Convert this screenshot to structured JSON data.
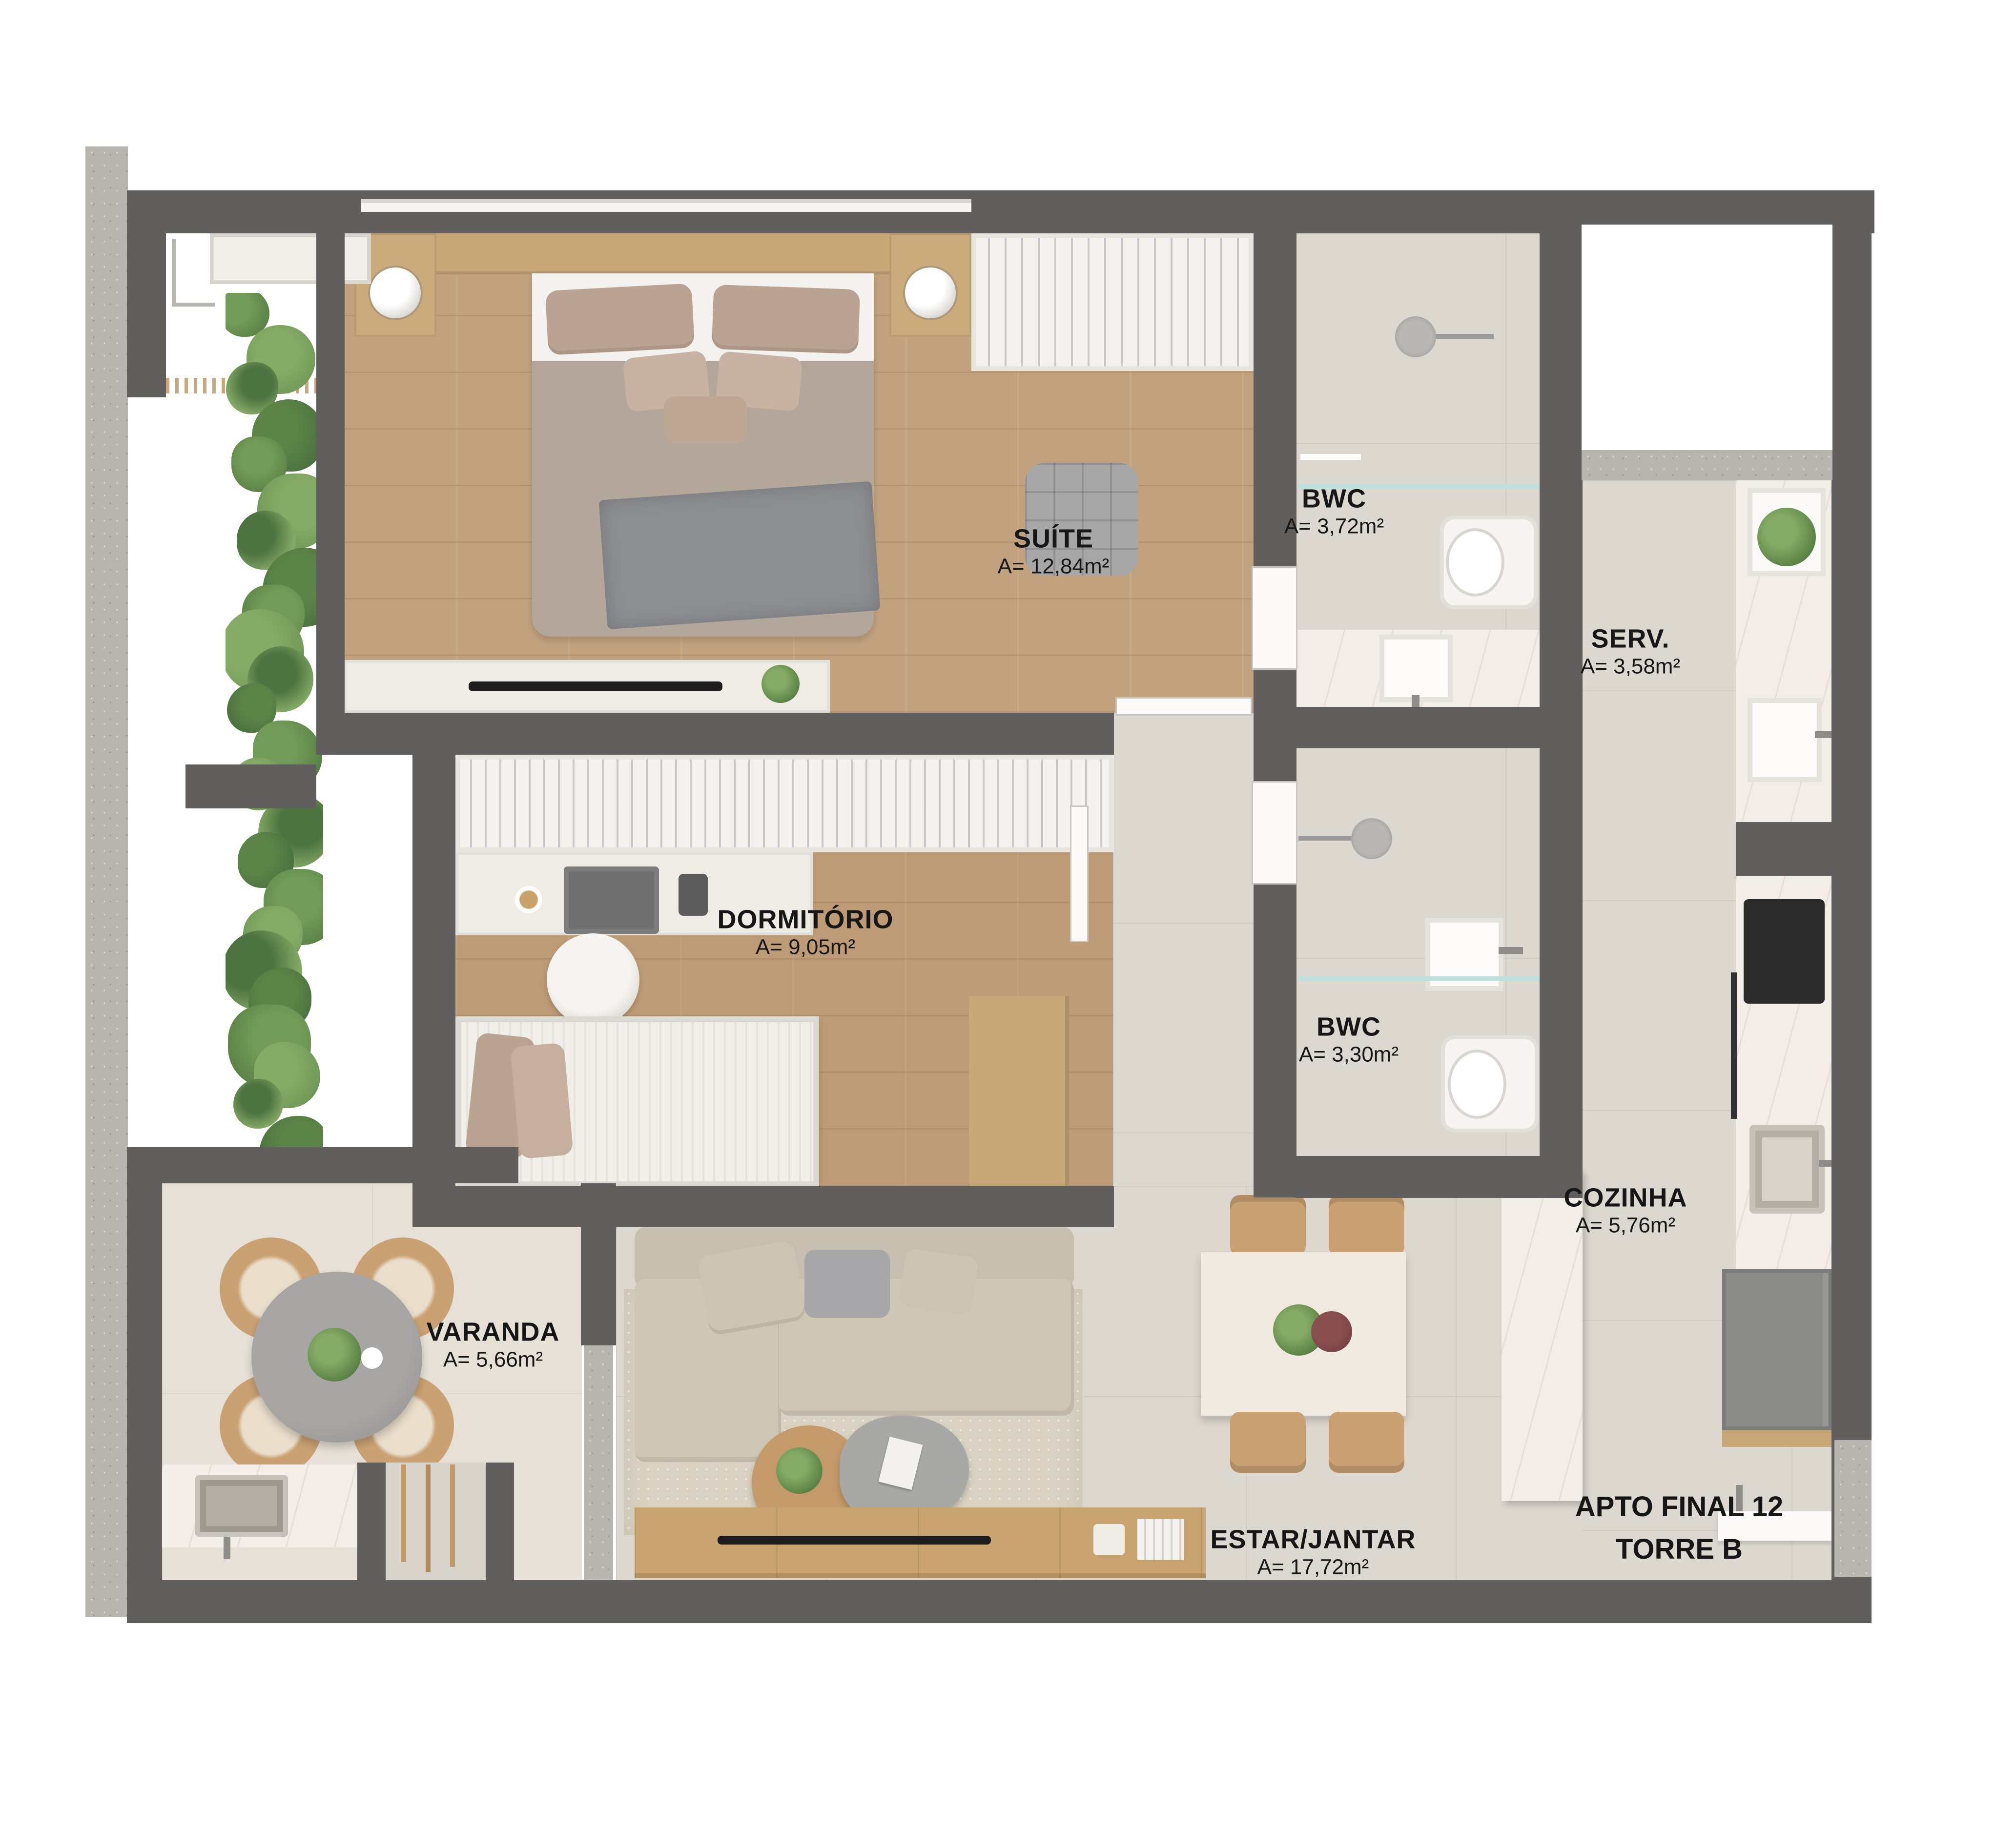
{
  "rooms": {
    "suite": {
      "name": "SUÍTE",
      "area": "A= 12,84m²"
    },
    "bwc_suite": {
      "name": "BWC",
      "area": "A= 3,72m²"
    },
    "serv": {
      "name": "SERV.",
      "area": "A= 3,58m²"
    },
    "dormitorio": {
      "name": "DORMITÓRIO",
      "area": "A= 9,05m²"
    },
    "bwc_social": {
      "name": "BWC",
      "area": "A= 3,30m²"
    },
    "cozinha": {
      "name": "COZINHA",
      "area": "A= 5,76m²"
    },
    "varanda": {
      "name": "VARANDA",
      "area": "A= 5,66m²"
    },
    "estar_jantar": {
      "name": "ESTAR/JANTAR",
      "area": "A= 17,72m²"
    }
  },
  "unit": {
    "line1": "APTO FINAL 12",
    "line2": "TORRE B"
  },
  "colors": {
    "wall": "#615f5d",
    "wood_floor": "#c2a27e",
    "tile_floor": "#dcd7cf",
    "varanda_floor": "#e7e0d6",
    "marble_counter": "#f2eee7",
    "concrete": "#b8b5af",
    "garden_green": "#5d8447",
    "label_text": "#161616"
  }
}
